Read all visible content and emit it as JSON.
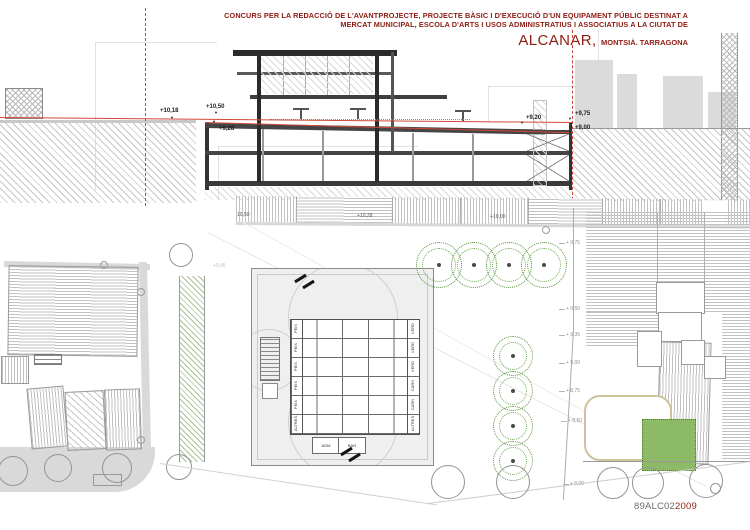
{
  "meta": {
    "colors": {
      "accent_red": "#8d1b12",
      "drawing_red": "#c94434",
      "tree_green": "#55923a",
      "plot_green": "#8cba67"
    }
  },
  "title": {
    "line1": "CONCURS PER LA REDACCIÓ DE L'AVANTPROJECTE, PROJECTE BÀSIC I D'EXECUCIÓ D'UN EQUIPAMENT PÚBLIC DESTINAT A",
    "line2": "MERCAT MUNICIPAL, ESCOLA D'ARTS I USOS ADMINISTRATIUS I ASSOCIATIUS A LA CIUTAT DE",
    "city": "ALCANAR,",
    "region": "MONTSIÀ. TARRAGONA"
  },
  "section": {
    "levels": [
      {
        "label": "+10,18"
      },
      {
        "label": "+10,50"
      },
      {
        "label": "+9,28"
      },
      {
        "label": "+9,20"
      },
      {
        "label": "+9,75"
      },
      {
        "label": "+9,00"
      }
    ]
  },
  "plan": {
    "street_labels": [
      {
        "label": "10,50"
      },
      {
        "label": "+10,28"
      },
      {
        "label": "+10,00"
      }
    ],
    "plaza_label": "+9,45",
    "right_labels": [
      {
        "label": "+ 9,75"
      },
      {
        "label": "+ 9,50"
      },
      {
        "label": "+ 9,35"
      },
      {
        "label": "+ 9,00"
      },
      {
        "label": "+ 8,75"
      },
      {
        "label": "+ 8,50"
      },
      {
        "label": "+ 8,00"
      }
    ],
    "market": {
      "stalls_left": [
        {
          "label": "PEIX"
        },
        {
          "label": "PEIX"
        },
        {
          "label": "PEIX"
        },
        {
          "label": "PEIX"
        },
        {
          "label": "PEIX"
        },
        {
          "label": "ALTRES"
        }
      ],
      "stalls_right": [
        {
          "label": "VERD"
        },
        {
          "label": "VERD"
        },
        {
          "label": "VERD"
        },
        {
          "label": "CARN"
        },
        {
          "label": "CARN"
        },
        {
          "label": "ALTRES"
        }
      ],
      "room1": "ADM",
      "room2": "BAR"
    }
  },
  "footer": {
    "code_prefix": "89ALC02",
    "code_suffix": "2009"
  }
}
